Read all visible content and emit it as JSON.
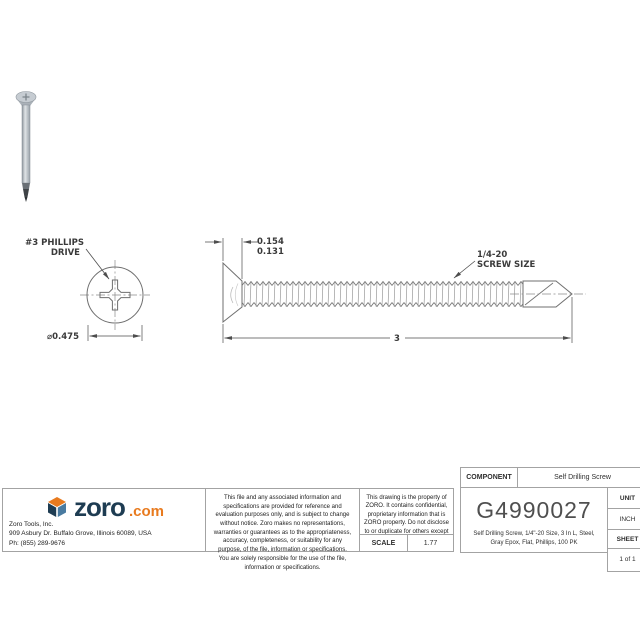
{
  "drawing": {
    "head_view": {
      "drive_label_line1": "#3 PHILLIPS",
      "drive_label_line2": "DRIVE",
      "diameter_dim": "⌀0.475"
    },
    "side_view": {
      "head_dim_max": "0.154",
      "head_dim_min": "0.131",
      "thread_label_line1": "1/4-20",
      "thread_label_line2": "SCREW SIZE",
      "length_dim": "3"
    }
  },
  "title_block": {
    "logo": {
      "brand": "zoro",
      "tld": ".com",
      "brand_color": "#1e3c52",
      "accent_color": "#e87a1e"
    },
    "company": {
      "name": "Zoro Tools, Inc.",
      "address": "909 Asbury Dr. Buffalo Grove, Illinois 60089, USA",
      "phone": "Ph: (855) 289-9676"
    },
    "disclaimer": "This file and any associated information and specifications are provided for reference and evaluation purposes only, and is subject to change without notice. Zoro makes no representations, warranties or guarantees as to the appropriateness, accuracy, completeness, or suitability for any purpose, of the file, information or specifications. You are solely responsible for the use of the file, information or specifications.",
    "property_notice": "This drawing is the property of ZORO. It contains confidential, proprietary information that is ZORO property. Do not disclose to or duplicate for others except as authorized by ZORO.",
    "scale_label": "SCALE",
    "scale_value": "1.77",
    "component_label": "COMPONENT",
    "component_value": "Self Drilling Screw",
    "part_number": "G4990027",
    "description": "Self Drilling Screw, 1/4\"-20 Size, 3 In L, Steel, Gray Epox, Flat, Phillips, 100 PK",
    "unit_label": "UNIT",
    "unit_value": "INCH",
    "sheet_label": "SHEET",
    "sheet_value": "1 of 1"
  }
}
